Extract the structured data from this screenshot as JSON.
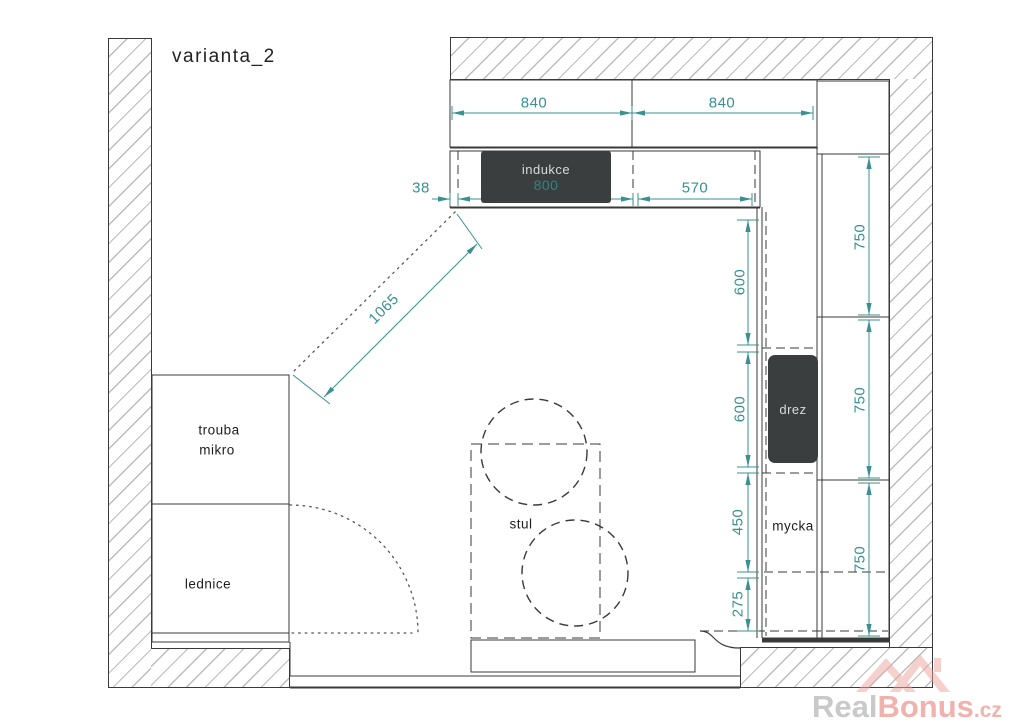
{
  "title": "varianta_2",
  "labels": {
    "cooktop": "indukce",
    "sink": "drez",
    "dishwasher": "mycka",
    "oven": "trouba",
    "microwave": "mikro",
    "fridge": "lednice",
    "table": "stul"
  },
  "dims": {
    "top": [
      "840",
      "840"
    ],
    "gap": "38",
    "cooktop_width": "800",
    "counter_right": "570",
    "left_chain": [
      "600",
      "600",
      "450",
      "275"
    ],
    "right_chain": [
      "750",
      "750",
      "750"
    ],
    "diagonal": "1065"
  },
  "watermark": {
    "part1": "Real",
    "part2": "Bonus",
    "tld": ".cz"
  },
  "colors": {
    "dimension": "#389090",
    "appliance_dark": "#3b3e3e",
    "line": "#3a3a3a",
    "hatch": "#bcbcbc",
    "watermark_gray": "#c9c9c9",
    "watermark_pink": "#f0b2ac"
  }
}
